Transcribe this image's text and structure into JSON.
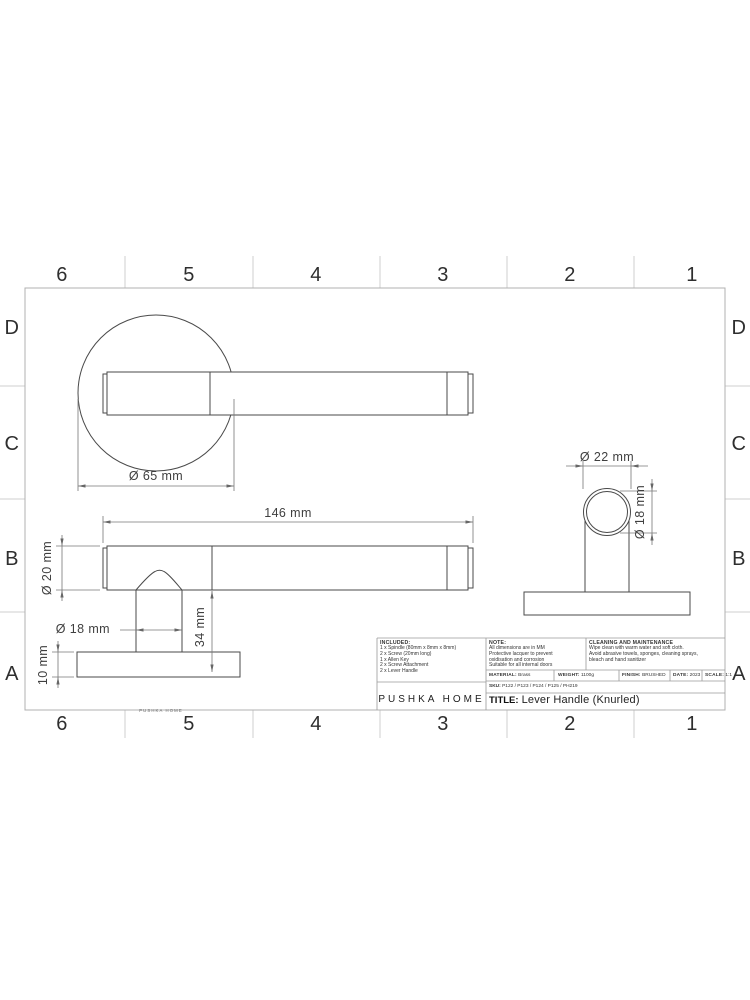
{
  "grid": {
    "cols": [
      "6",
      "5",
      "4",
      "3",
      "2",
      "1"
    ],
    "rows": [
      "D",
      "C",
      "B",
      "A"
    ]
  },
  "dimensions": {
    "rose_diameter": "Ø 65 mm",
    "lever_length": "146 mm",
    "bar_diameter": "Ø 20 mm",
    "stem_diameter": "Ø 18 mm",
    "projection_height": "34 mm",
    "rose_thickness": "10 mm",
    "end_outer_diameter": "Ø 22 mm",
    "end_inner_diameter": "Ø 18 mm"
  },
  "watermark": "PUSHKA HOME",
  "title_block": {
    "included": {
      "heading": "INCLUDED:",
      "items": [
        "1 x Spindle  (80mm x 8mm x 8mm)",
        "2 x Screw  (20mm long)",
        "1 x Allen Key",
        "2 x Screw Attachment",
        "2 x Lever Handle"
      ]
    },
    "note": {
      "heading": "NOTE:",
      "lines": [
        "All dimensions are in MM",
        "Protective lacquer to prevent",
        "oxidisation and corrosion",
        "Suitable for all internal doors"
      ]
    },
    "cleaning": {
      "heading": "CLEANING AND MAINTENANCE",
      "lines": [
        "Wipe clean with warm water and soft cloth.",
        "Avoid abrasive towels, sponges, cleaning sprays,",
        "bleach and hand sanitizer"
      ]
    },
    "specs": [
      {
        "label": "MATERIAL:",
        "value": "Brass"
      },
      {
        "label": "WEIGHT:",
        "value": "1100g"
      },
      {
        "label": "FINISH:",
        "value": "BRUSHED"
      },
      {
        "label": "DATE:",
        "value": "2023"
      },
      {
        "label": "SCALE:",
        "value": "1:1"
      }
    ],
    "sku": {
      "label": "SKU:",
      "value": "P122 / P123 / P124 / P125 / PH219"
    },
    "brand": "PUSHKA HOME",
    "title": {
      "label": "TITLE:",
      "value": "Lever Handle (Knurled)"
    }
  },
  "colors": {
    "part_line": "#4a4a4a",
    "dimension_line": "#777777",
    "frame": "#b0b0b0",
    "background": "#ffffff"
  }
}
